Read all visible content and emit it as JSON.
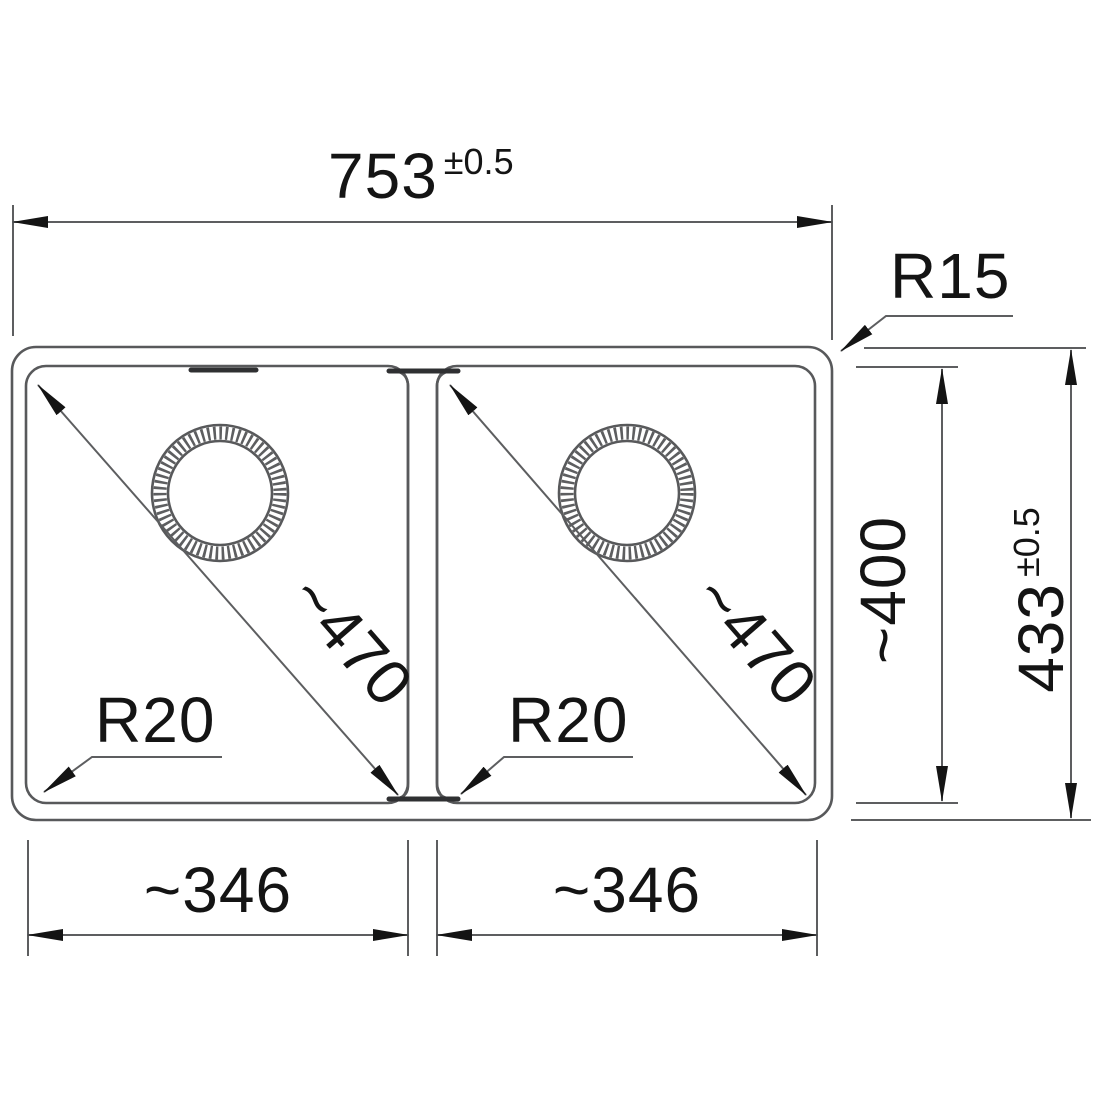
{
  "drawing": {
    "type": "technical-dimension-drawing",
    "subject": "double-bowl-sink-top-view",
    "colors": {
      "line": "#5d5e60",
      "outline": "#58595b",
      "text": "#141414",
      "arrow": "#141414",
      "background": "#ffffff"
    },
    "dims": {
      "overall_width": {
        "value": "753",
        "tolerance": "±0.5"
      },
      "overall_height": {
        "value": "433",
        "tolerance": "±0.5"
      },
      "outer_corner_radius": "R15",
      "inner_height": "~400",
      "left_bowl": {
        "diagonal": "~470",
        "corner_radius": "R20",
        "width": "~346"
      },
      "right_bowl": {
        "diagonal": "~470",
        "corner_radius": "R20",
        "width": "~346"
      }
    }
  }
}
